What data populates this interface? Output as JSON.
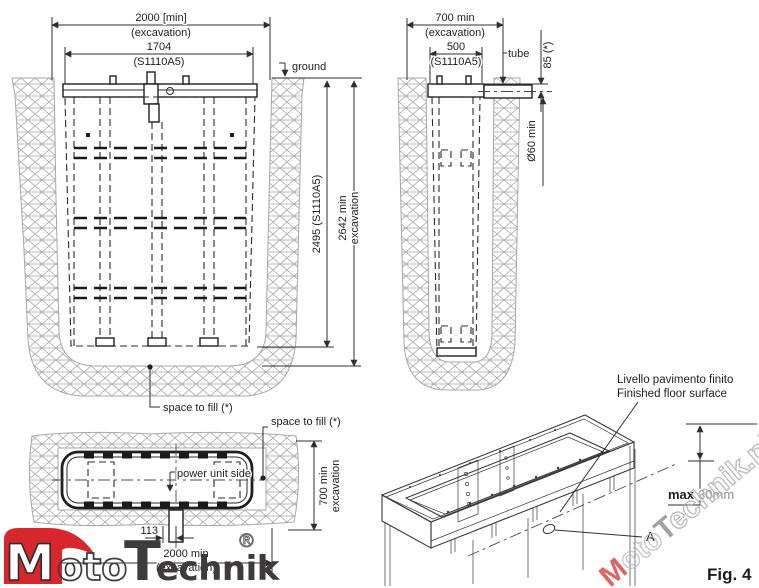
{
  "figure": {
    "label": "Fig. 4"
  },
  "front_view": {
    "dim_excavation_width": "2000  [min]",
    "dim_excavation_width_sub": "(excavation)",
    "dim_unit_width": "1704",
    "dim_unit_width_sub": "(S1110A5)",
    "ground_label": "ground",
    "dim_unit_height": "2495  (S1110A5)",
    "dim_excavation_depth": "2642  min",
    "dim_excavation_depth_sub": "excavation",
    "space_to_fill_label": "space to fill (*)"
  },
  "side_view": {
    "dim_excavation_width": "700  min",
    "dim_excavation_width_sub": "(excavation)",
    "dim_unit_width": "500",
    "dim_unit_width_sub": "(S1110A5)",
    "tube_label": "tube",
    "dim_tube_depth": "85  (*)",
    "dim_tube_diameter": "Ø60 min"
  },
  "top_view": {
    "space_to_fill_label": "space to fill (*)",
    "power_unit_label": "power unit side",
    "dim_excavation_depth": "700  min",
    "dim_excavation_depth_sub": "excavation",
    "dim_tube_offset": "113",
    "dim_excavation_width": "2000  min",
    "dim_excavation_width_sub": "(excavation)"
  },
  "iso_view": {
    "floor_label_it": "Livello pavimento finito",
    "floor_label_en": "Finished floor surface",
    "max_label": "max",
    "max_value": "30mm",
    "detail_label": "A"
  },
  "logo": {
    "part_m": "M",
    "part_oto": "oto",
    "part_t": "T",
    "part_echnik": "echnik",
    "registered": "®"
  },
  "watermark": {
    "part_m": "M",
    "part_oto": "oto",
    "part_t": "T",
    "part_rest": "echnik.pl"
  },
  "colors": {
    "line": "#2f2f2f",
    "hatch": "#a9a6a6",
    "logo_red": "#d7262c",
    "logo_dark": "#3d3b3c",
    "value_gray": "#8f8f8f",
    "watermark_gray": "#b5b2b2",
    "watermark_red": "#cf5049"
  }
}
